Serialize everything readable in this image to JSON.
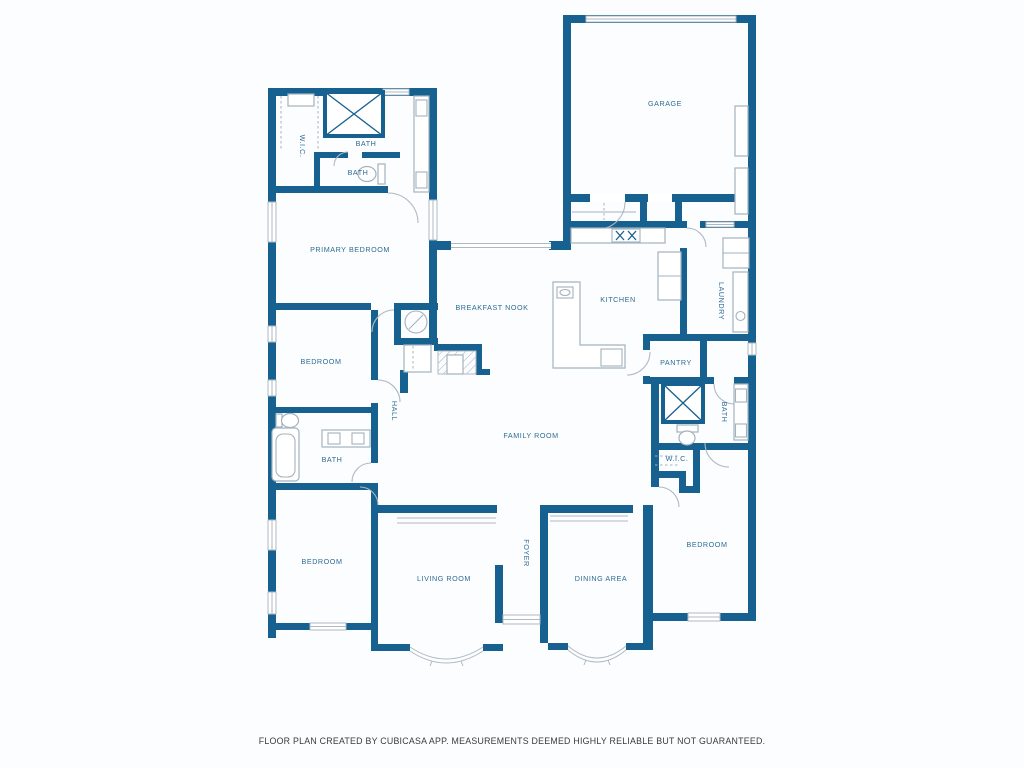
{
  "colors": {
    "wall": "#16618f",
    "label": "#2e6b94",
    "line": "#aeb9c2",
    "fixture": "#a3b2bd",
    "hatch": "#9fb0bc",
    "footer_text": "#3a3a3a",
    "background": "#fcfdfe"
  },
  "rooms": {
    "garage": {
      "label": "GARAGE"
    },
    "wic_top": {
      "label": "W.I.C."
    },
    "bath_top": {
      "label": "BATH"
    },
    "bath_top_small": {
      "label": "BATH"
    },
    "primary_bedroom": {
      "label": "PRIMARY BEDROOM"
    },
    "breakfast_nook": {
      "label": "BREAKFAST NOOK"
    },
    "kitchen": {
      "label": "KITCHEN"
    },
    "laundry": {
      "label": "LAUNDRY"
    },
    "bedroom_left": {
      "label": "BEDROOM"
    },
    "hall": {
      "label": "HALL"
    },
    "pantry": {
      "label": "PANTRY"
    },
    "family_room": {
      "label": "FAMILY ROOM"
    },
    "bath_left": {
      "label": "BATH"
    },
    "bath_right": {
      "label": "BATH"
    },
    "wic_right": {
      "label": "W.I.C."
    },
    "bedroom_bottom_left": {
      "label": "BEDROOM"
    },
    "living_room": {
      "label": "LIVING ROOM"
    },
    "foyer": {
      "label": "FOYER"
    },
    "dining_area": {
      "label": "DINING AREA"
    },
    "bedroom_bottom_right": {
      "label": "BEDROOM"
    }
  },
  "footer": {
    "disclaimer": "FLOOR PLAN CREATED BY CUBICASA APP. MEASUREMENTS DEEMED HIGHLY RELIABLE BUT NOT GUARANTEED."
  }
}
